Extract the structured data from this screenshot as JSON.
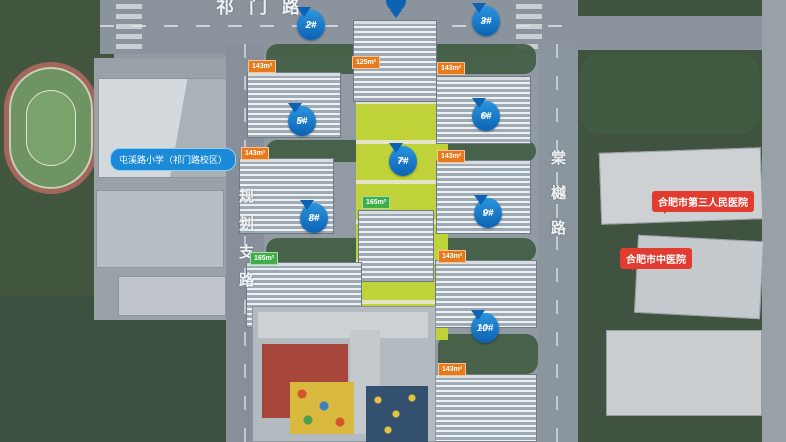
{
  "roads": {
    "top": "祁门路",
    "left": "规划支路",
    "right": "棠樾路"
  },
  "poi": {
    "school": "屯溪路小学（祁门路校区）",
    "hospital_a": "合肥市第三人民医院",
    "hospital_b": "合肥市中医院"
  },
  "pins": {
    "b2": {
      "label": "2#",
      "sub": "17F"
    },
    "b3": {
      "label": "3#",
      "sub": "17F"
    },
    "b5": {
      "label": "5#",
      "sub": "34F"
    },
    "b6": {
      "label": "6#",
      "sub": "34F"
    },
    "b7": {
      "label": "7#",
      "sub": "26F"
    },
    "b8": {
      "label": "8#",
      "sub": "10F"
    },
    "b9": {
      "label": "9#",
      "sub": "17F"
    },
    "b10": {
      "label": "10#",
      "sub": "10F"
    }
  },
  "tags": {
    "row1": [
      {
        "t": "125m²",
        "c": "orange"
      },
      {
        "t": "165m²",
        "c": "green"
      },
      {
        "t": "185m²",
        "c": "green"
      },
      {
        "t": "125m²",
        "c": "orange"
      }
    ],
    "row2": [
      {
        "t": "143m²",
        "c": "orange"
      },
      {
        "t": "123m²",
        "c": "blue"
      },
      {
        "t": "128m²",
        "c": "blue"
      },
      {
        "t": "143m²",
        "c": "orange"
      }
    ],
    "row3": [
      {
        "t": "143m²",
        "c": "orange"
      },
      {
        "t": "125m²",
        "c": "blue"
      },
      {
        "t": "125m²",
        "c": "blue"
      },
      {
        "t": "143m²",
        "c": "orange"
      }
    ],
    "row5": [
      {
        "t": "143m²",
        "c": "orange"
      },
      {
        "t": "125m²",
        "c": "blue"
      },
      {
        "t": "125m²",
        "c": "blue"
      },
      {
        "t": "143m²",
        "c": "orange"
      }
    ],
    "row6": [
      {
        "t": "143m²",
        "c": "orange"
      },
      {
        "t": "125m²",
        "c": "blue"
      },
      {
        "t": "125m²",
        "c": "blue"
      },
      {
        "t": "143m²",
        "c": "orange"
      }
    ],
    "row7": [
      {
        "t": "165m²",
        "c": "green"
      },
      {
        "t": "165m²",
        "c": "green"
      }
    ],
    "row8": [
      {
        "t": "165m²",
        "c": "green"
      },
      {
        "t": "165m²",
        "c": "green"
      },
      {
        "t": "165m²",
        "c": "green"
      },
      {
        "t": "165m²",
        "c": "green"
      }
    ],
    "row9": [
      {
        "t": "143m²",
        "c": "orange"
      },
      {
        "t": "121m²",
        "c": "blue"
      },
      {
        "t": "125m²",
        "c": "blue"
      },
      {
        "t": "143m²",
        "c": "orange"
      }
    ],
    "row10": [
      {
        "t": "143m²",
        "c": "orange"
      },
      {
        "t": "143m²",
        "c": "orange"
      },
      {
        "t": "143m²",
        "c": "orange"
      },
      {
        "t": "143m²",
        "c": "orange"
      }
    ]
  },
  "colors": {
    "pin_blue": "#0d62b4",
    "tag_orange": "#e87a1e",
    "tag_blue": "#1b7fd4",
    "tag_green": "#3fae49",
    "poi_blue": "#1b8ad8",
    "poi_red": "#e23c30"
  }
}
